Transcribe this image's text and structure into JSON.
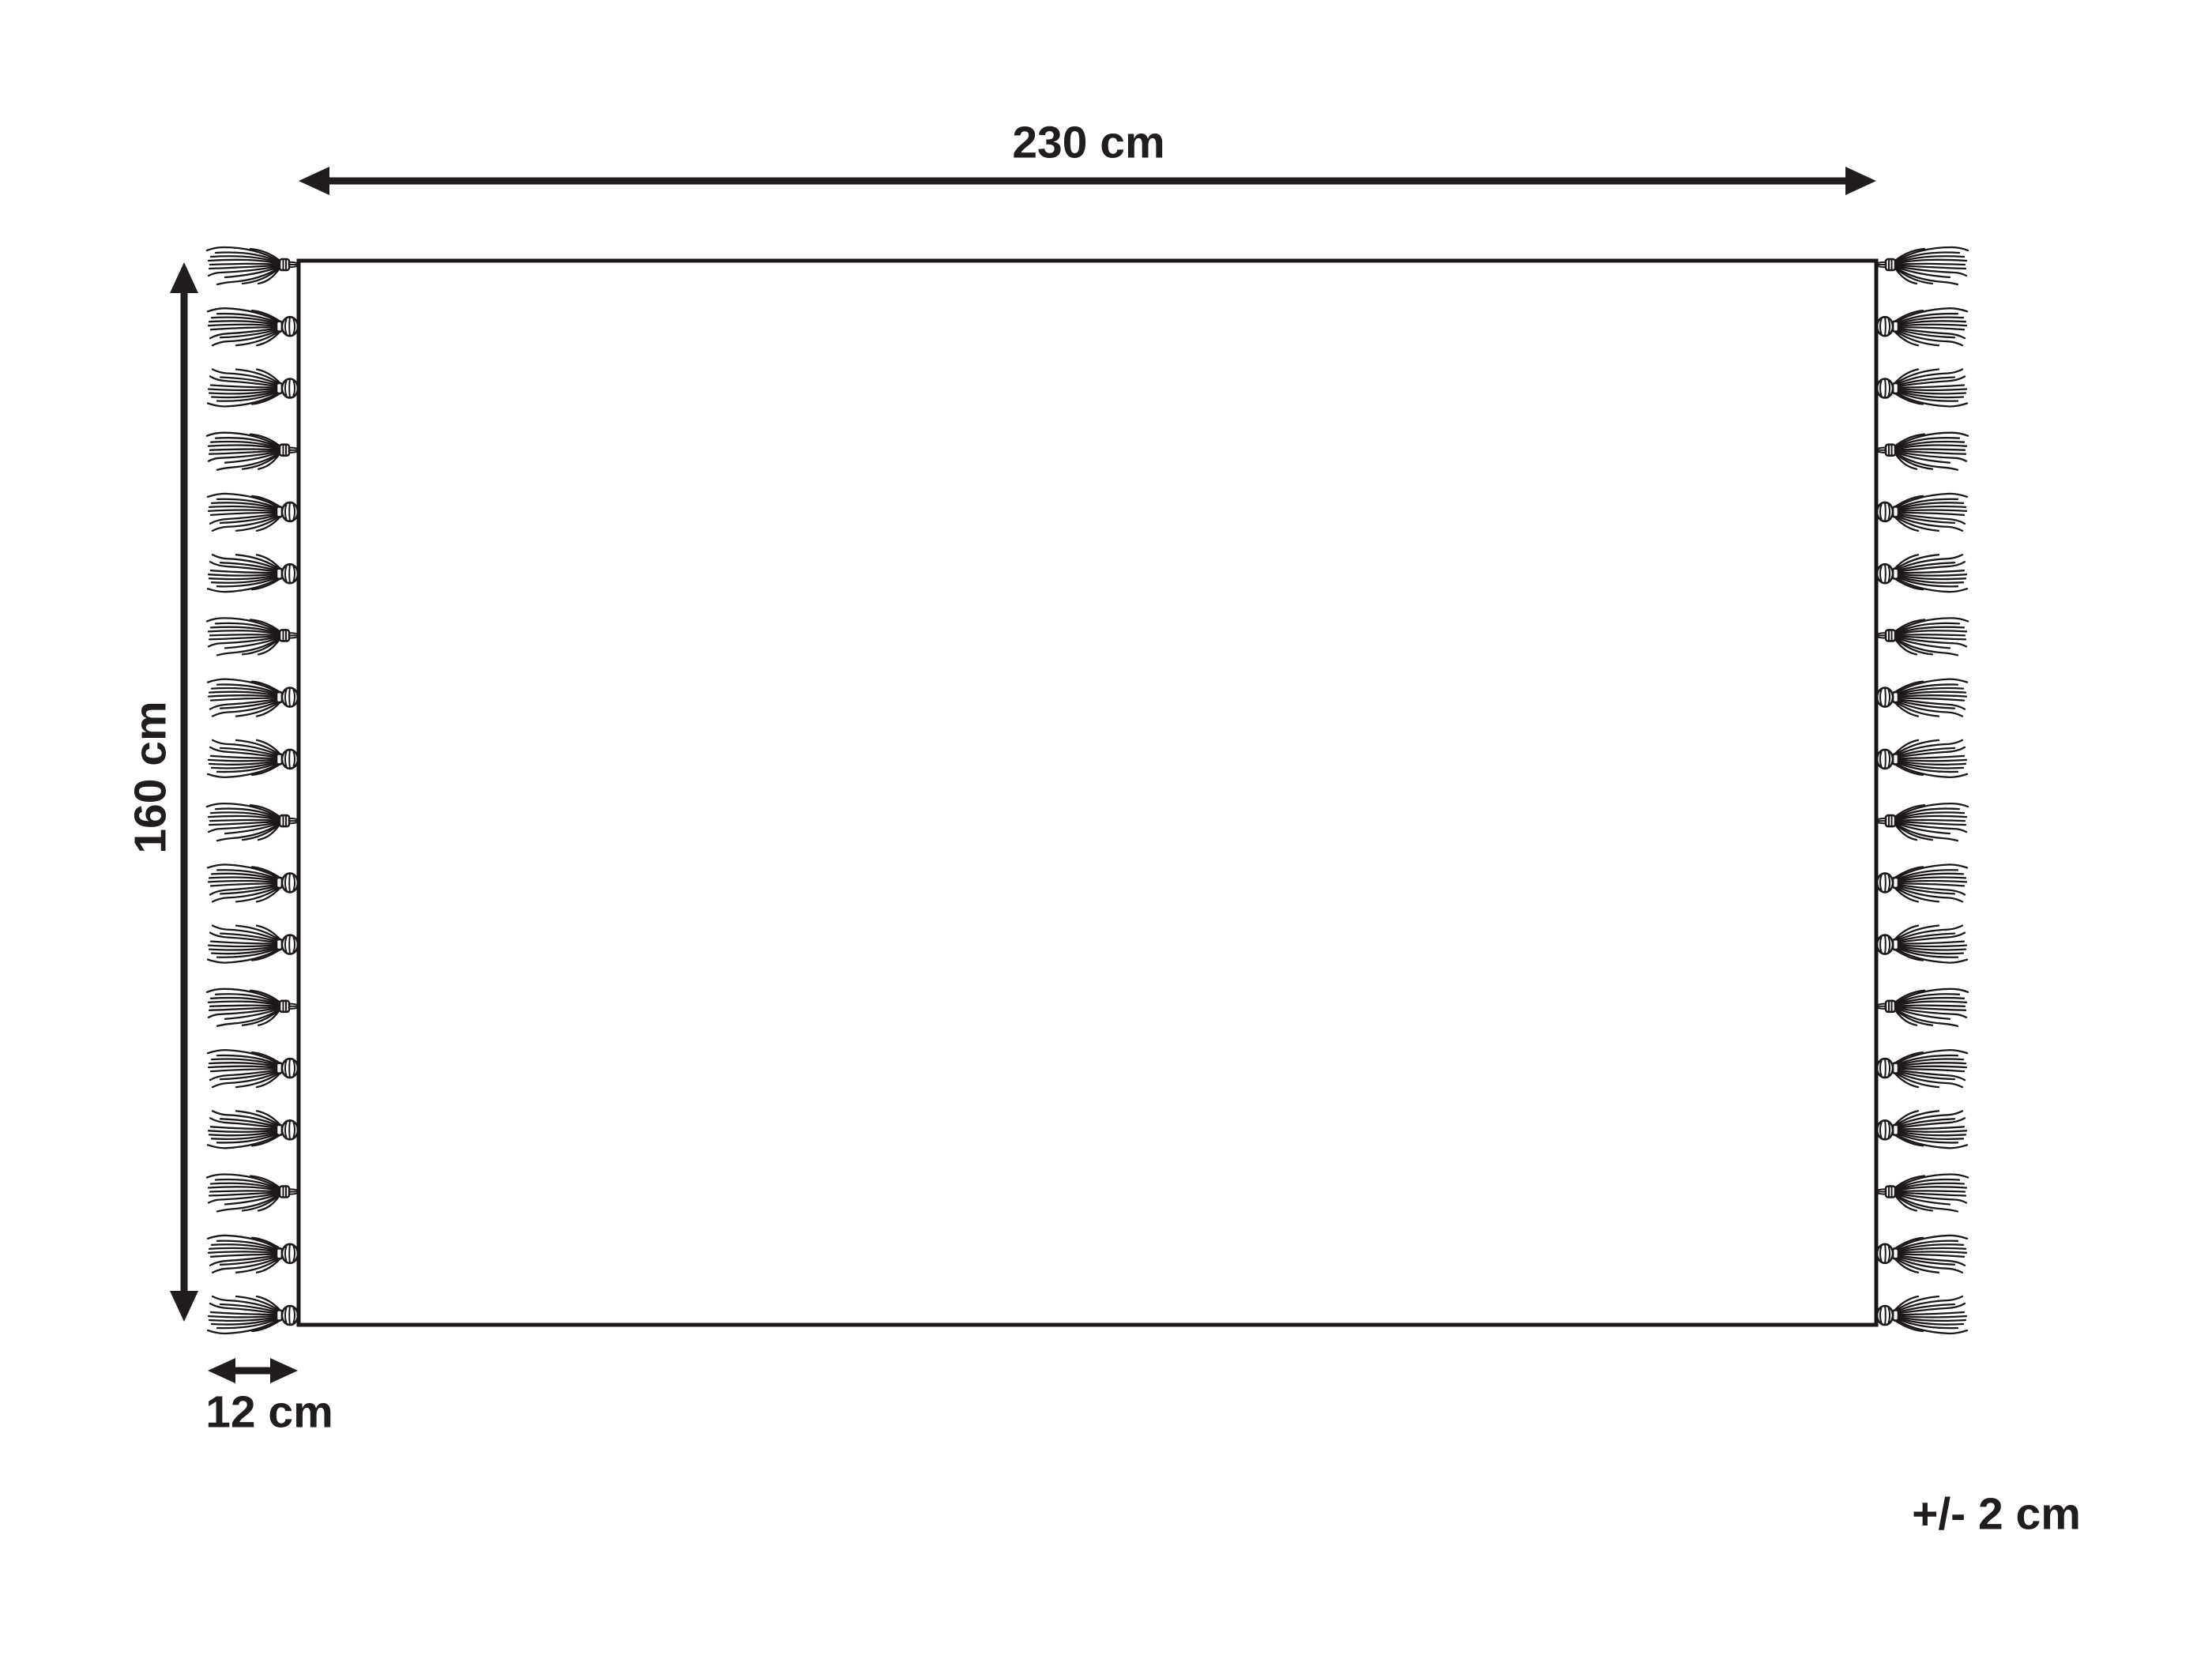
{
  "diagram": {
    "type": "product-dimension-diagram",
    "subject": "rectangular rug with tassel fringe on left and right edges",
    "background_color": "#ffffff",
    "ink_color": "#211d1e",
    "labels": {
      "width": "230 cm",
      "height": "160 cm",
      "tassel_length": "12 cm",
      "tolerance": "+/- 2 cm"
    },
    "tassels": {
      "per_side": 18,
      "sides": [
        "left",
        "right"
      ]
    }
  }
}
